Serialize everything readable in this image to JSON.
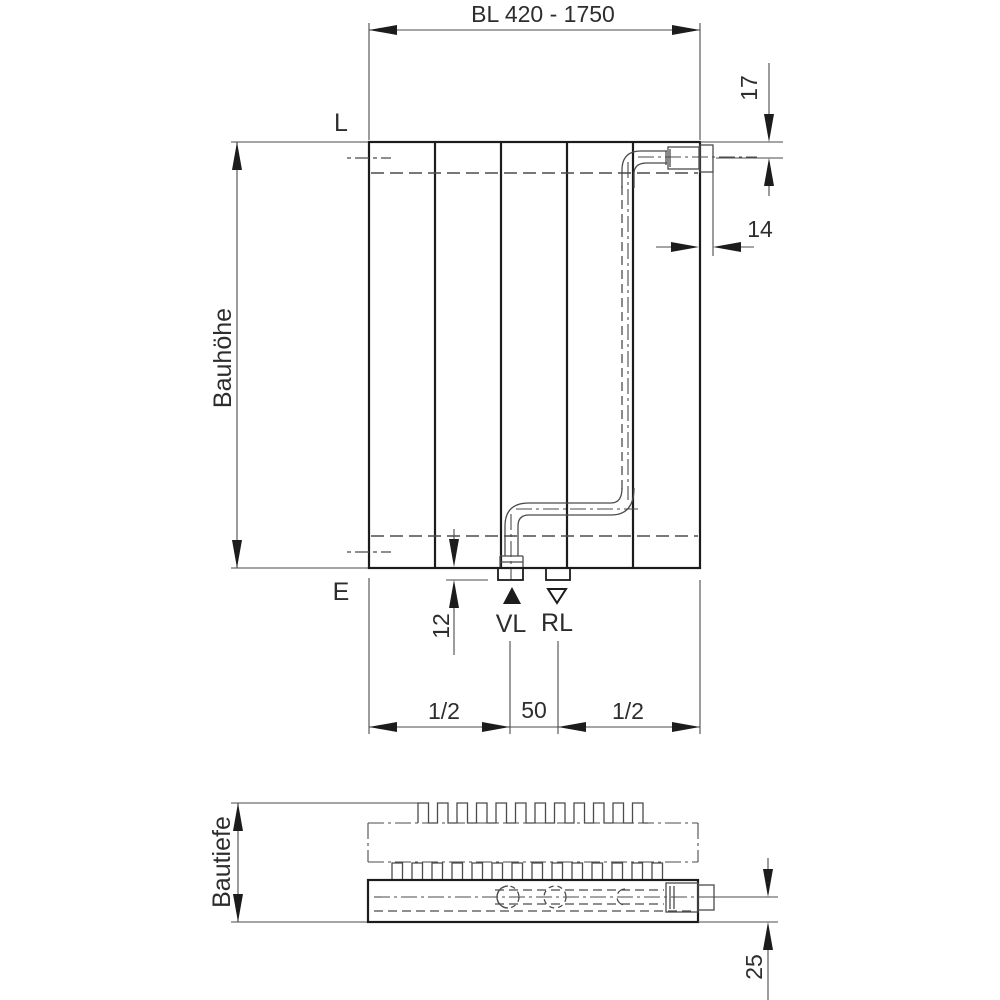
{
  "drawing": {
    "front_view": {
      "build_length_label": "BL 420 - 1750",
      "build_height_label": "Bauhöhe",
      "vent_side_label": "L",
      "drain_side_label": "E",
      "supply_label": "VL",
      "return_label": "RL",
      "supply_marker": "filled-up-triangle",
      "return_marker": "open-down-triangle",
      "dims": {
        "connection_center_from_top": "17",
        "connection_protrusion": "14",
        "tapping_protrusion": "12",
        "connection_spacing": "50",
        "half_left": "1/2",
        "half_right": "1/2"
      }
    },
    "plan_view": {
      "build_depth_label": "Bautiefe",
      "dims": {
        "connection_center_from_bottom": "25"
      }
    },
    "colors": {
      "line": "#1c1c1c",
      "thin": "#4b4b4b",
      "text": "#2d2d2d",
      "bg": "#ffffff"
    }
  }
}
